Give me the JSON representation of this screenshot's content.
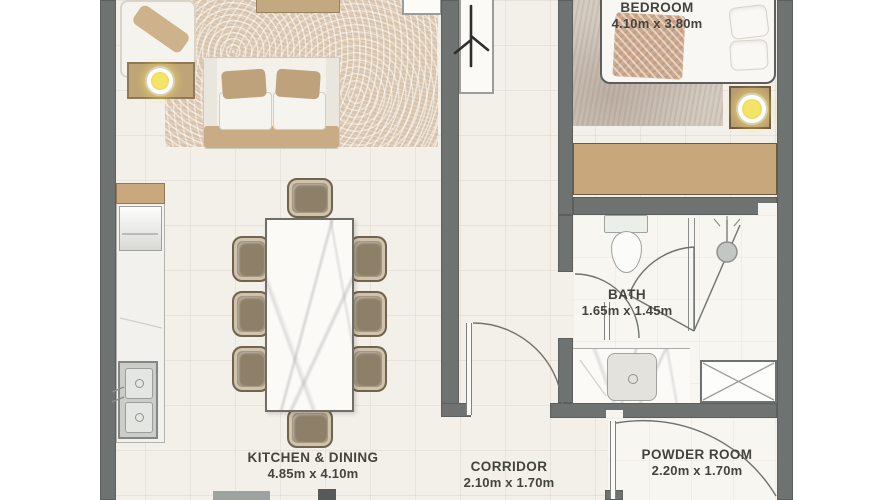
{
  "title": "apartment-floor-plan",
  "rooms": [
    {
      "name": "BEDROOM",
      "dims": "4.10m x 3.80m"
    },
    {
      "name": "BATH",
      "dims": "1.65m x 1.45m"
    },
    {
      "name": "KITCHEN & DINING",
      "dims": "4.85m x 4.10m"
    },
    {
      "name": "CORRIDOR",
      "dims": "2.10m x 1.70m"
    },
    {
      "name": "POWDER ROOM",
      "dims": "2.20m x 1.70m"
    }
  ],
  "furniture": [
    "sofa",
    "throw-pillows",
    "armchair",
    "coffee-table",
    "side-table-lamp",
    "area-rug",
    "dining-table",
    "dining-chairs",
    "kitchen-counter",
    "refrigerator",
    "oven",
    "double-sink",
    "console-table",
    "plant-decor",
    "wall-shelf",
    "bed",
    "bed-pillows",
    "bed-blanket",
    "bedroom-rug",
    "nightstand-lamp",
    "wardrobe",
    "toilet",
    "shower-head",
    "shower-door",
    "vanity-basin",
    "service-shaft",
    "door-swings"
  ],
  "colors": {
    "wall": "#6e7271",
    "floor": "#f3f0e9",
    "wood_tan": "#c9a87e",
    "lamp_glow": "#f0df60",
    "label_text": "#44443e"
  }
}
